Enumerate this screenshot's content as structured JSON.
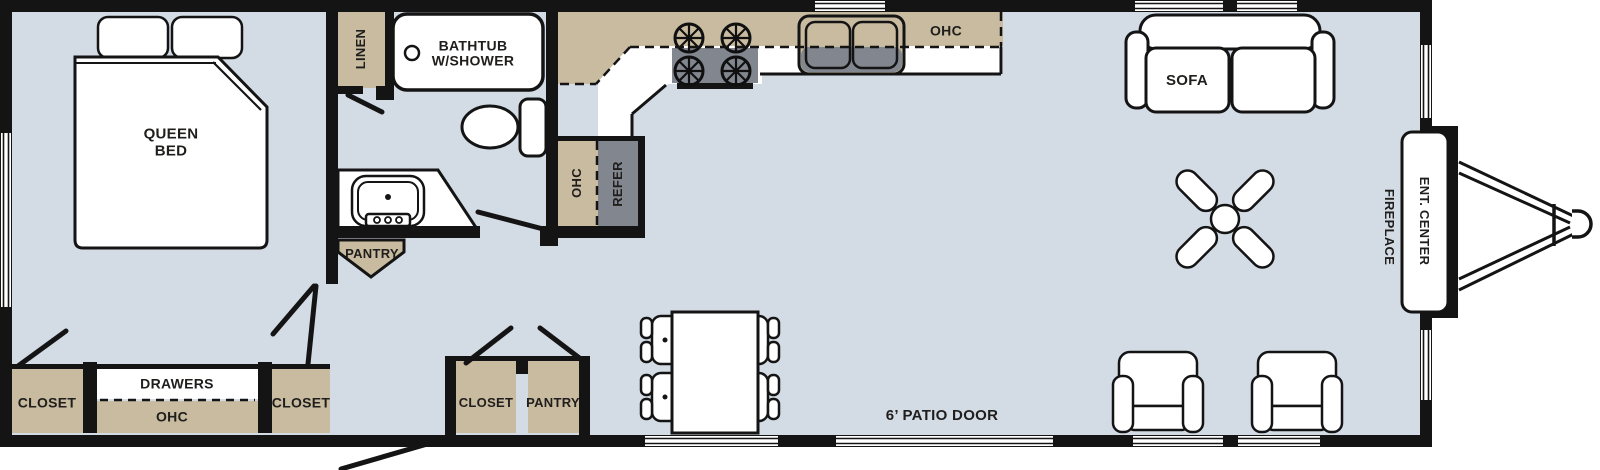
{
  "labels": {
    "queen_bed_line1": "QUEEN",
    "queen_bed_line2": "BED",
    "linen": "LINEN",
    "bathtub_line1": "BATHTUB",
    "bathtub_line2": "W/SHOWER",
    "pantry_bath": "PANTRY",
    "ohc_kitchen_side": "OHC",
    "refer": "REFER",
    "ohc_kitchen_top": "OHC",
    "closet_bed_left": "CLOSET",
    "drawers": "DRAWERS",
    "ohc_bedroom": "OHC",
    "closet_bed_right": "CLOSET",
    "closet_entry": "CLOSET",
    "pantry_entry": "PANTRY",
    "patio_door": "6’ PATIO DOOR",
    "sofa": "SOFA",
    "fireplace": "FIREPLACE",
    "ent_center": "ENT. CENTER"
  },
  "colors": {
    "floor": "#d3dbe5",
    "cabinet": "#c8bb9f",
    "appliance": "#82878f",
    "wall": "#141414",
    "fixture": "#ffffff",
    "text": "#1f1e1c"
  }
}
